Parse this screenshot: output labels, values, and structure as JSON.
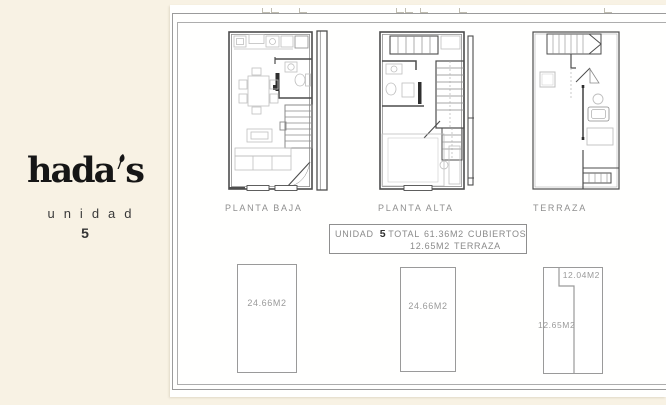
{
  "brand": {
    "name_start": "hada",
    "name_end": "s",
    "unit_word": "unidad",
    "unit_number": "5"
  },
  "plans": [
    {
      "label": "PLANTA BAJA"
    },
    {
      "label": "PLANTA ALTA"
    },
    {
      "label": "TERRAZA"
    }
  ],
  "summary": {
    "unidad_label": "UNIDAD",
    "unit_number": "5",
    "total_label": "TOTAL",
    "covered_area": "61.36M2",
    "covered_label": "CUBIERTOS",
    "terrace_area": "12.65M2",
    "terrace_label": "TERRAZA"
  },
  "area_shapes": {
    "ground": "24.66M2",
    "upper": "24.66M2",
    "terrace_top": "12.04M2",
    "terrace_left": "12.65M2"
  },
  "colors": {
    "background": "#f8f2e4",
    "sheet": "#fffffe",
    "wall_line": "#4d4d4d",
    "furniture_line": "#bfbfbf",
    "cad_text": "#8f8f8f",
    "logo": "#161616"
  }
}
